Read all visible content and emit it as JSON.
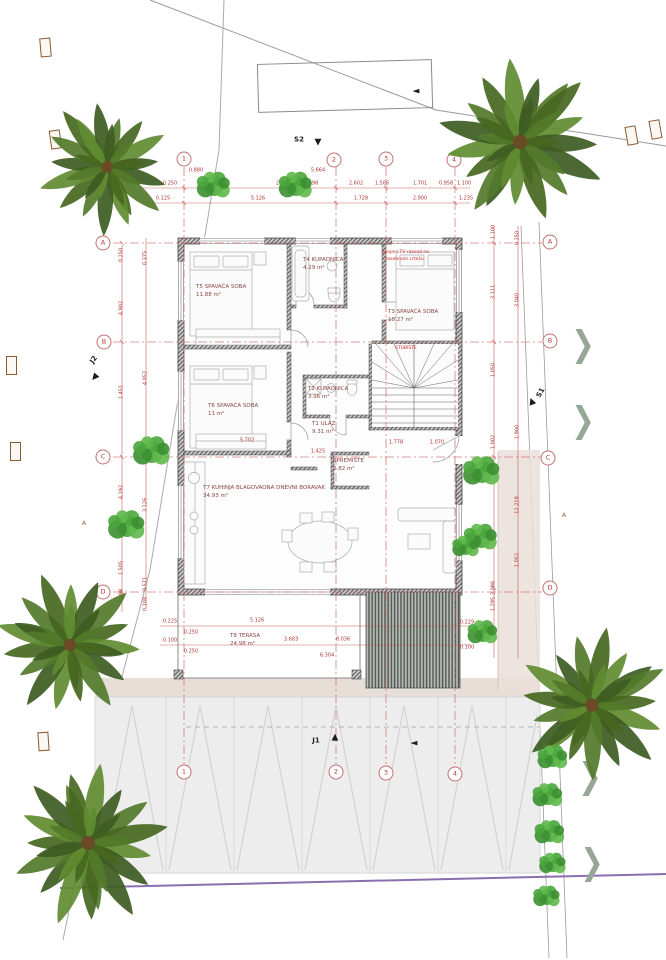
{
  "colors": {
    "dimension_red": "#c0504d",
    "axis_red": "#cc6a6a",
    "label_maroon": "#8b4545",
    "note_red": "#cc2a2a",
    "boundary_purple": "#7e5fa8",
    "palm_greens": [
      "#3e5c22",
      "#527a2a",
      "#47671f",
      "#618c31"
    ],
    "bush_greens": [
      "#49a63c",
      "#5fb94a",
      "#3c8f31"
    ]
  },
  "chevron_glyph": "❯",
  "grid": {
    "top": [
      {
        "label": "1",
        "x": 184,
        "y": 159
      },
      {
        "label": "2",
        "x": 334,
        "y": 160
      },
      {
        "label": "3",
        "x": 386,
        "y": 159
      },
      {
        "label": "4",
        "x": 454,
        "y": 160
      }
    ],
    "bottom": [
      {
        "label": "1",
        "x": 184,
        "y": 772
      },
      {
        "label": "2",
        "x": 336,
        "y": 772
      },
      {
        "label": "3",
        "x": 386,
        "y": 773
      },
      {
        "label": "4",
        "x": 455,
        "y": 774
      }
    ],
    "left": [
      {
        "label": "A",
        "x": 103,
        "y": 243
      },
      {
        "label": "B",
        "x": 104,
        "y": 342
      },
      {
        "label": "C",
        "x": 103,
        "y": 457
      },
      {
        "label": "D",
        "x": 103,
        "y": 592
      }
    ],
    "right": [
      {
        "label": "A",
        "x": 550,
        "y": 242
      },
      {
        "label": "B",
        "x": 550,
        "y": 341
      },
      {
        "label": "C",
        "x": 548,
        "y": 458
      },
      {
        "label": "D",
        "x": 550,
        "y": 588
      }
    ]
  },
  "rooms": [
    {
      "name": "T5 SPAVAĆA SOBA",
      "area": "11.88 m²",
      "x": 196,
      "y": 283
    },
    {
      "name": "T4 KUPAONICA",
      "area": "4.29 m²",
      "x": 303,
      "y": 256
    },
    {
      "name": "T3 SPAVAĆA SOBA",
      "area": "10.27 m²",
      "x": 388,
      "y": 308
    },
    {
      "name": "T6 SPAVAĆA SOBA",
      "area": "11 m²",
      "x": 208,
      "y": 402
    },
    {
      "name": "T2 KUPAONICA",
      "area": "3.96 m²",
      "x": 308,
      "y": 385
    },
    {
      "name": "T1 ULAZ",
      "area": "9.31 m²",
      "x": 312,
      "y": 420
    },
    {
      "name": "SPREMIŠTE",
      "area": "2.82 m²",
      "x": 333,
      "y": 457
    },
    {
      "name": "T7 KUHINJA BLAGOVAONA DNEVNI BORAVAK",
      "area": "34.93 m²",
      "x": 203,
      "y": 484
    },
    {
      "name": "T8 TERASA",
      "area": "24.98 m²",
      "x": 230,
      "y": 632
    }
  ],
  "notes": [
    {
      "text": "spojeni TV razvod na",
      "x": 382,
      "y": 250
    },
    {
      "text": "zasebnom crtežu",
      "x": 385,
      "y": 257
    },
    {
      "text": "STUBIŠTE",
      "x": 395,
      "y": 346
    }
  ],
  "markers": [
    {
      "text": "S2",
      "x": 299,
      "y": 140,
      "rot": 0
    },
    {
      "text": "J1",
      "x": 316,
      "y": 741,
      "rot": 0
    },
    {
      "text": "J2",
      "x": 94,
      "y": 360,
      "rot": -55
    },
    {
      "text": "S1",
      "x": 541,
      "y": 393,
      "rot": -60
    },
    {
      "text": "A",
      "x": 84,
      "y": 524,
      "rot": 0,
      "section": true
    },
    {
      "text": "A",
      "x": 564,
      "y": 516,
      "rot": 0,
      "section": true
    }
  ],
  "arrows": [
    {
      "glyph": "▼",
      "x": 318,
      "y": 143,
      "rot": 0
    },
    {
      "glyph": "▲",
      "x": 335,
      "y": 738,
      "rot": 0
    },
    {
      "glyph": "▼",
      "x": 94,
      "y": 378,
      "rot": 40
    },
    {
      "glyph": "▲",
      "x": 532,
      "y": 402,
      "rot": -20
    },
    {
      "glyph": "◄",
      "x": 416,
      "y": 92,
      "rot": 0
    },
    {
      "glyph": "◄",
      "x": 414,
      "y": 744,
      "rot": 0
    }
  ],
  "chevrons": [
    {
      "x": 583,
      "y": 344
    },
    {
      "x": 583,
      "y": 420
    },
    {
      "x": 590,
      "y": 776
    },
    {
      "x": 592,
      "y": 862
    }
  ],
  "posts": [
    {
      "x": 40,
      "y": 38,
      "r": -5
    },
    {
      "x": 50,
      "y": 130,
      "r": -8
    },
    {
      "x": 6,
      "y": 356,
      "r": 0
    },
    {
      "x": 10,
      "y": 442,
      "r": 0
    },
    {
      "x": 626,
      "y": 126,
      "r": -10
    },
    {
      "x": 650,
      "y": 120,
      "r": -10
    },
    {
      "x": 38,
      "y": 732,
      "r": -4
    }
  ],
  "trees": [
    {
      "x": 107,
      "y": 167,
      "r": 72,
      "s": 1
    },
    {
      "x": 520,
      "y": 142,
      "r": 90,
      "s": 2
    },
    {
      "x": 70,
      "y": 645,
      "r": 78,
      "s": 3
    },
    {
      "x": 88,
      "y": 843,
      "r": 87,
      "s": 4
    },
    {
      "x": 592,
      "y": 705,
      "r": 82,
      "s": 5
    }
  ],
  "bushes": [
    {
      "x": 214,
      "y": 186,
      "r": 10
    },
    {
      "x": 296,
      "y": 186,
      "r": 10
    },
    {
      "x": 152,
      "y": 452,
      "r": 11
    },
    {
      "x": 127,
      "y": 526,
      "r": 11
    },
    {
      "x": 482,
      "y": 472,
      "r": 11
    },
    {
      "x": 481,
      "y": 538,
      "r": 10
    },
    {
      "x": 466,
      "y": 547,
      "r": 8
    },
    {
      "x": 483,
      "y": 633,
      "r": 9
    },
    {
      "x": 553,
      "y": 758,
      "r": 9
    },
    {
      "x": 548,
      "y": 796,
      "r": 9
    },
    {
      "x": 550,
      "y": 833,
      "r": 9
    },
    {
      "x": 553,
      "y": 864,
      "r": 8
    },
    {
      "x": 547,
      "y": 897,
      "r": 8
    }
  ],
  "dimensions": [
    {
      "t": "0.880",
      "x": 196,
      "y": 171
    },
    {
      "t": "5.664",
      "x": 318,
      "y": 171
    },
    {
      "t": "0.250",
      "x": 170,
      "y": 184
    },
    {
      "t": "1.401",
      "x": 215,
      "y": 184
    },
    {
      "t": "2.262",
      "x": 283,
      "y": 184
    },
    {
      "t": "6.498",
      "x": 311,
      "y": 184
    },
    {
      "t": "2.602",
      "x": 356,
      "y": 184
    },
    {
      "t": "1.586",
      "x": 382,
      "y": 184
    },
    {
      "t": "1.701",
      "x": 420,
      "y": 184
    },
    {
      "t": "0.958",
      "x": 446,
      "y": 184
    },
    {
      "t": "1.100",
      "x": 464,
      "y": 184
    },
    {
      "t": "0.125",
      "x": 163,
      "y": 199
    },
    {
      "t": "5.126",
      "x": 258,
      "y": 199
    },
    {
      "t": "1.728",
      "x": 361,
      "y": 199
    },
    {
      "t": "2.900",
      "x": 420,
      "y": 199
    },
    {
      "t": "1.235",
      "x": 466,
      "y": 199
    },
    {
      "t": "0.250",
      "x": 122,
      "y": 255,
      "v": 1
    },
    {
      "t": "4.902",
      "x": 122,
      "y": 308,
      "v": 1
    },
    {
      "t": "1.451",
      "x": 122,
      "y": 392,
      "v": 1
    },
    {
      "t": "4.192",
      "x": 122,
      "y": 492,
      "v": 1
    },
    {
      "t": "1.505",
      "x": 122,
      "y": 568,
      "v": 1
    },
    {
      "t": "0.098",
      "x": 122,
      "y": 596,
      "v": 1
    },
    {
      "t": "0.375",
      "x": 146,
      "y": 258,
      "v": 1
    },
    {
      "t": "4.052",
      "x": 146,
      "y": 378,
      "v": 1
    },
    {
      "t": "3.126",
      "x": 146,
      "y": 505,
      "v": 1
    },
    {
      "t": "0.571",
      "x": 146,
      "y": 584,
      "v": 1
    },
    {
      "t": "0.108",
      "x": 146,
      "y": 604,
      "v": 1
    },
    {
      "t": "1.100",
      "x": 494,
      "y": 232,
      "v": 1
    },
    {
      "t": "3.111",
      "x": 494,
      "y": 292,
      "v": 1
    },
    {
      "t": "1.050",
      "x": 494,
      "y": 370,
      "v": 1
    },
    {
      "t": "1.002",
      "x": 494,
      "y": 442,
      "v": 1
    },
    {
      "t": "2.096",
      "x": 494,
      "y": 588,
      "v": 1
    },
    {
      "t": "1.295",
      "x": 494,
      "y": 604,
      "v": 1
    },
    {
      "t": "0.250",
      "x": 518,
      "y": 238,
      "v": 1
    },
    {
      "t": "3.040",
      "x": 518,
      "y": 300,
      "v": 1
    },
    {
      "t": "1.900",
      "x": 518,
      "y": 432,
      "v": 1
    },
    {
      "t": "12.218",
      "x": 518,
      "y": 505,
      "v": 1
    },
    {
      "t": "1.052",
      "x": 518,
      "y": 560,
      "v": 1
    },
    {
      "t": "0.225",
      "x": 170,
      "y": 622
    },
    {
      "t": "0.100",
      "x": 170,
      "y": 641
    },
    {
      "t": "0.250",
      "x": 191,
      "y": 633
    },
    {
      "t": "0.250",
      "x": 191,
      "y": 652
    },
    {
      "t": "5.126",
      "x": 257,
      "y": 621
    },
    {
      "t": "3.683",
      "x": 291,
      "y": 640
    },
    {
      "t": "8.036",
      "x": 343,
      "y": 640
    },
    {
      "t": "6.304",
      "x": 327,
      "y": 656
    },
    {
      "t": "0.229",
      "x": 467,
      "y": 623
    },
    {
      "t": "0.100",
      "x": 467,
      "y": 648
    },
    {
      "t": "5.702",
      "x": 247,
      "y": 441
    },
    {
      "t": "1.425",
      "x": 318,
      "y": 452
    },
    {
      "t": "1.778",
      "x": 396,
      "y": 443
    },
    {
      "t": "1.070",
      "x": 437,
      "y": 443
    }
  ]
}
